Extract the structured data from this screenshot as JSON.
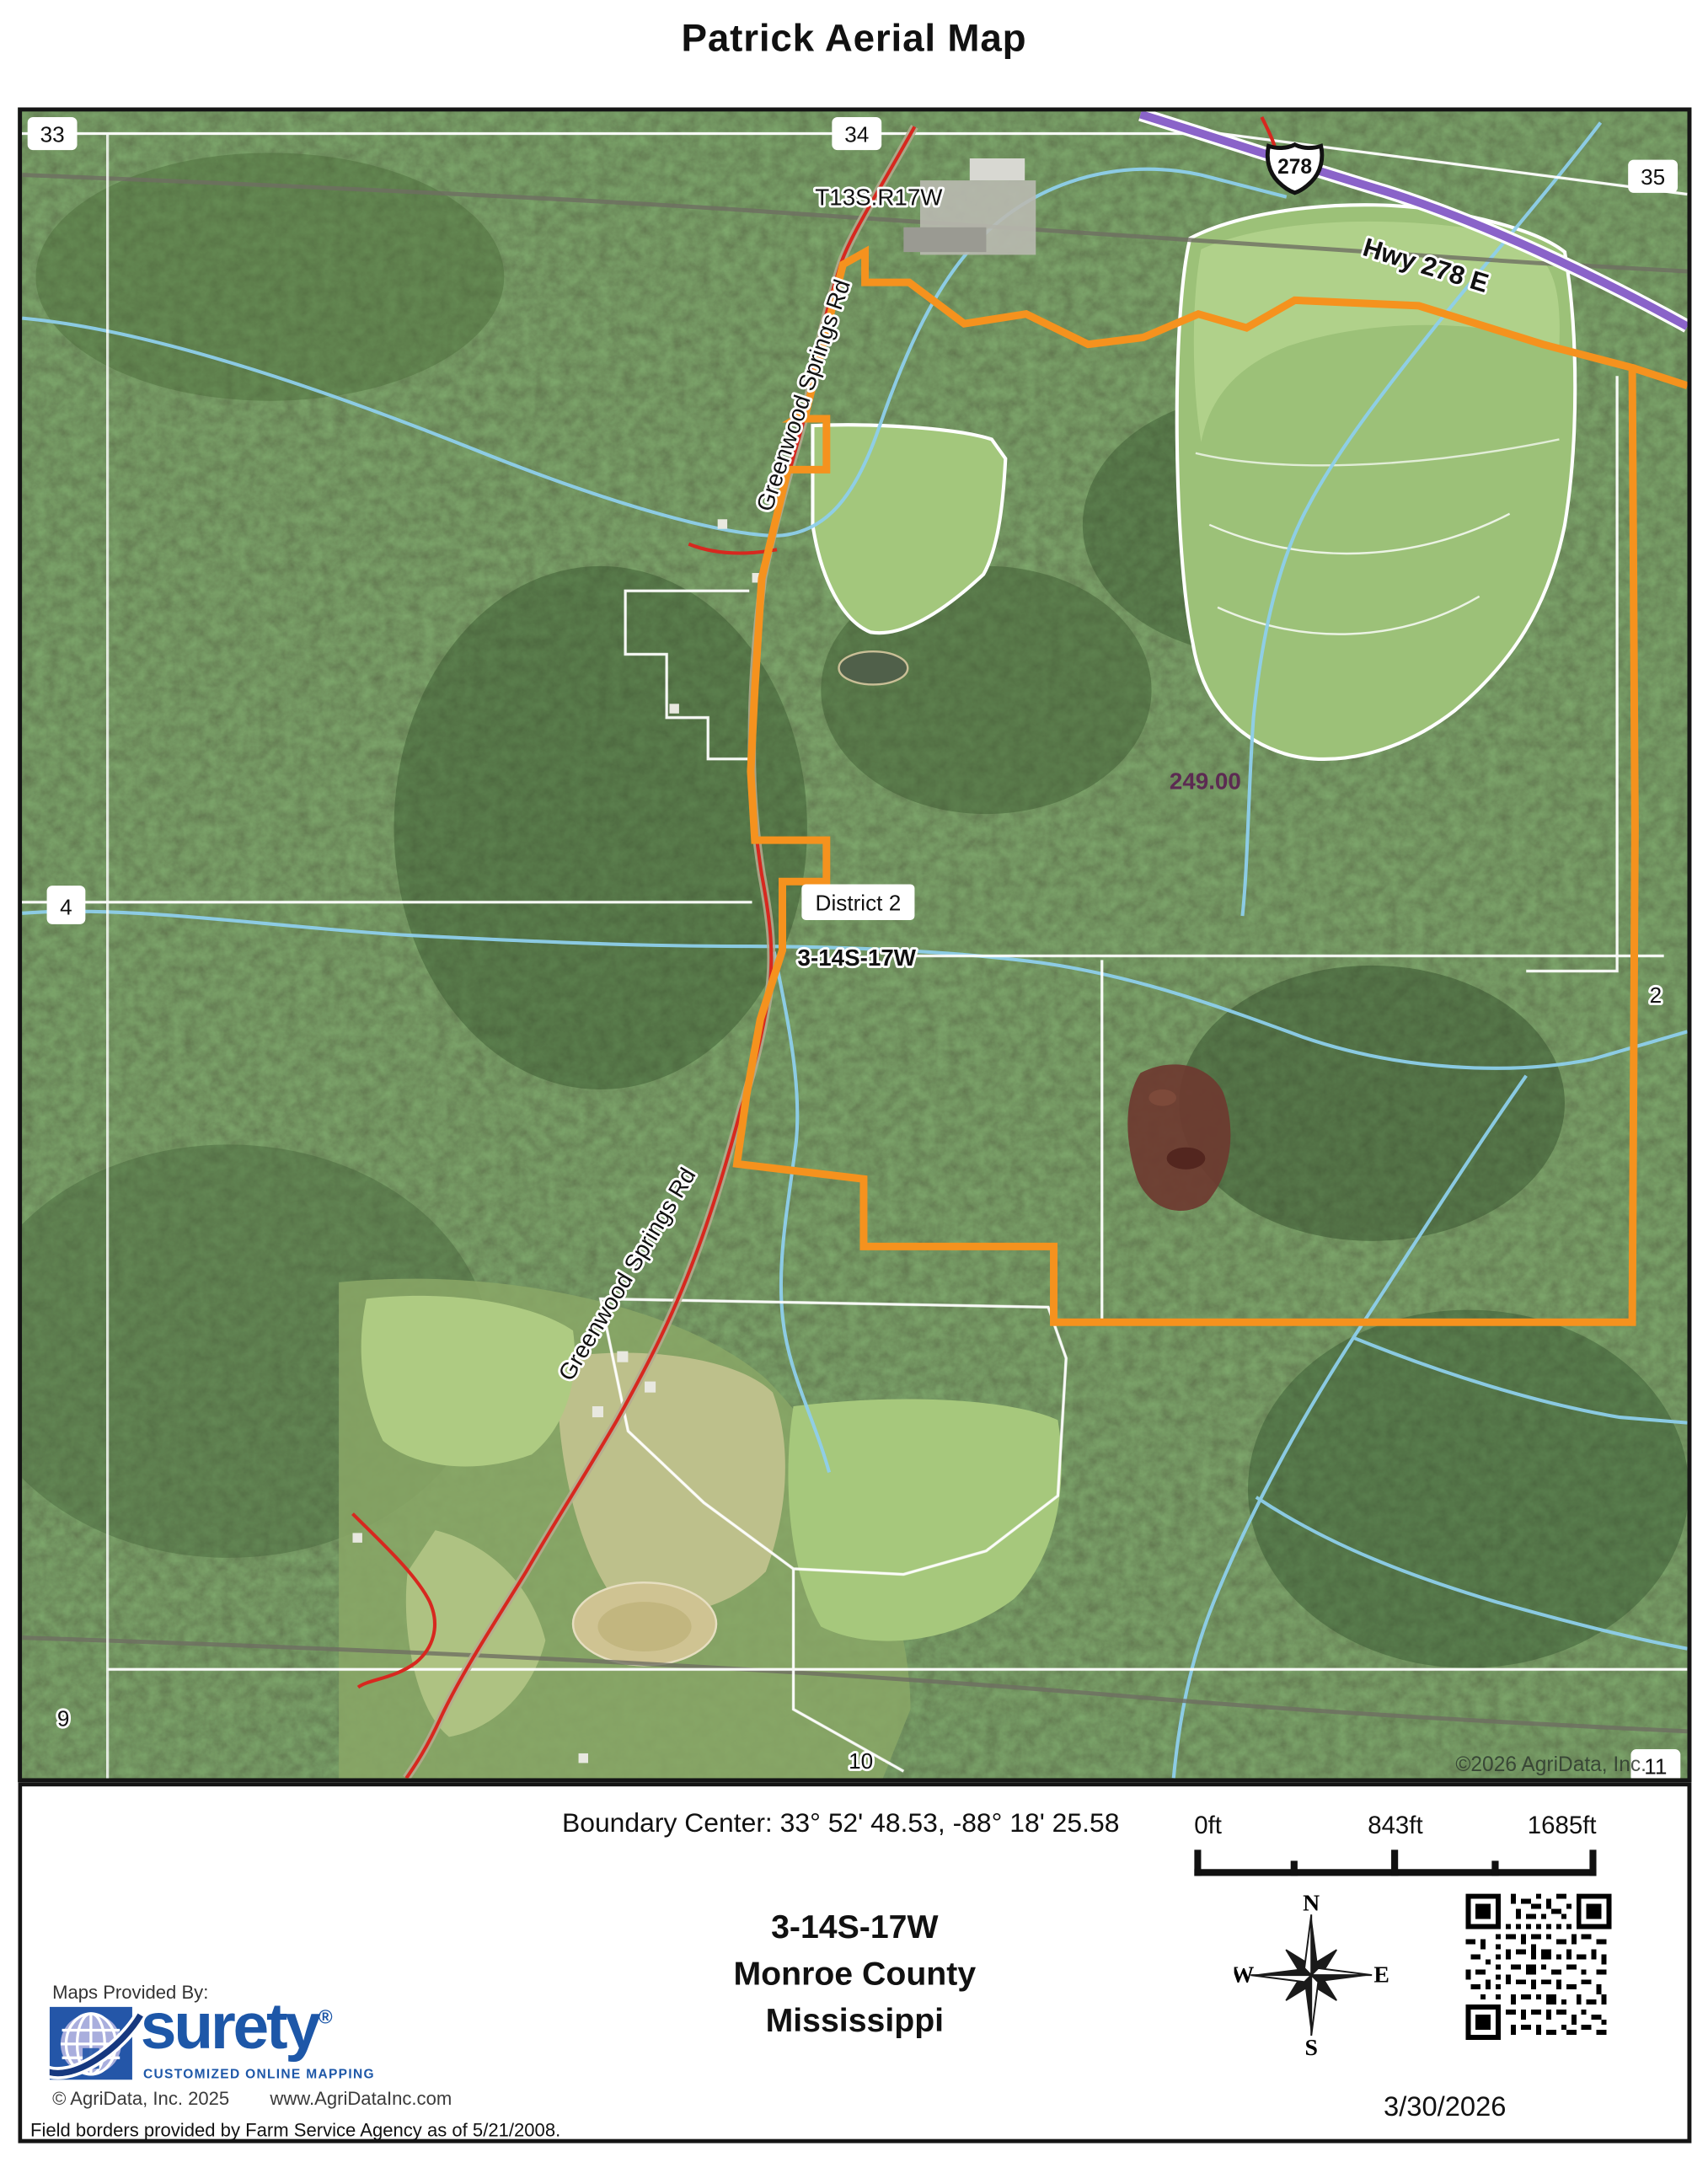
{
  "title": "Patrick Aerial Map",
  "map": {
    "copyright": "©2026 AgriData, Inc.",
    "labels": {
      "section_33": "33",
      "section_34": "34",
      "section_35": "35",
      "section_4": "4",
      "section_2": "2",
      "section_9": "9",
      "section_10": "10",
      "section_11": "11",
      "township": "T13S.R17W",
      "district": "District 2",
      "trs_line": "3-14S-17W",
      "acreage": "249.00",
      "road_upper": "Greenwood Springs Rd",
      "road_lower": "Greenwood Springs Rd",
      "highway": "Hwy 278 E",
      "route_shield": "278"
    },
    "colors": {
      "boundary": "#F5921E",
      "highway": "#8A63C9",
      "road": "#D7281F",
      "stream": "#8ECFEB",
      "parcel_line": "#FFFFFF",
      "acreage_text": "#5C2A52",
      "forest": "#3A5730",
      "field": "#9CC178"
    }
  },
  "footer": {
    "boundary_center": "Boundary Center: 33° 52' 48.53,  -88° 18' 25.58",
    "scale": {
      "ticks": [
        "0ft",
        "843ft",
        "1685ft"
      ]
    },
    "location": {
      "trs": "3-14S-17W",
      "county": "Monroe County",
      "state": "Mississippi"
    },
    "provider": {
      "heading": "Maps Provided By:",
      "brand": "surety",
      "registered": "®",
      "tagline": "CUSTOMIZED ONLINE MAPPING",
      "copyright": "© AgriData, Inc. 2025",
      "website": "www.AgriDataInc.com"
    },
    "compass": {
      "n": "N",
      "e": "E",
      "s": "S",
      "w": "W"
    },
    "date": "3/30/2026",
    "disclaimer": "Field borders provided by Farm Service Agency as of 5/21/2008."
  }
}
